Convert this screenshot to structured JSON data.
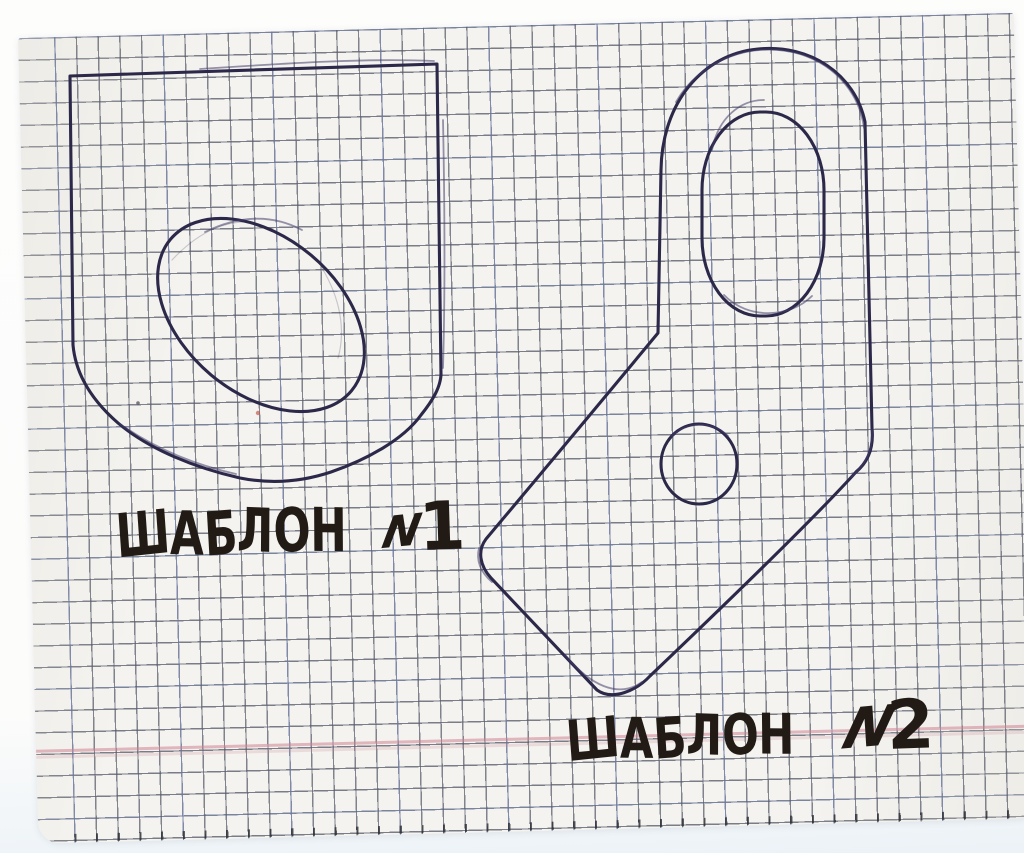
{
  "labels": {
    "template1": {
      "word": "ШАБЛОН",
      "numero_sign": "N",
      "number": "1"
    },
    "template2": {
      "word": "ШАБЛОН",
      "numero_sign": "N",
      "number": "2"
    }
  },
  "colors": {
    "scanner_background": "#fcfcfb",
    "paper": "#f4f3ef",
    "grid_line_gray": "#585c6a",
    "grid_line_blue": "#8096d4",
    "margin_line_pink": "#cf8292",
    "pen_ink": "#2c2849",
    "pen_ink_overdraw": "#433d6b",
    "marker_text": "#221b15",
    "red_speck": "#c0504a"
  }
}
